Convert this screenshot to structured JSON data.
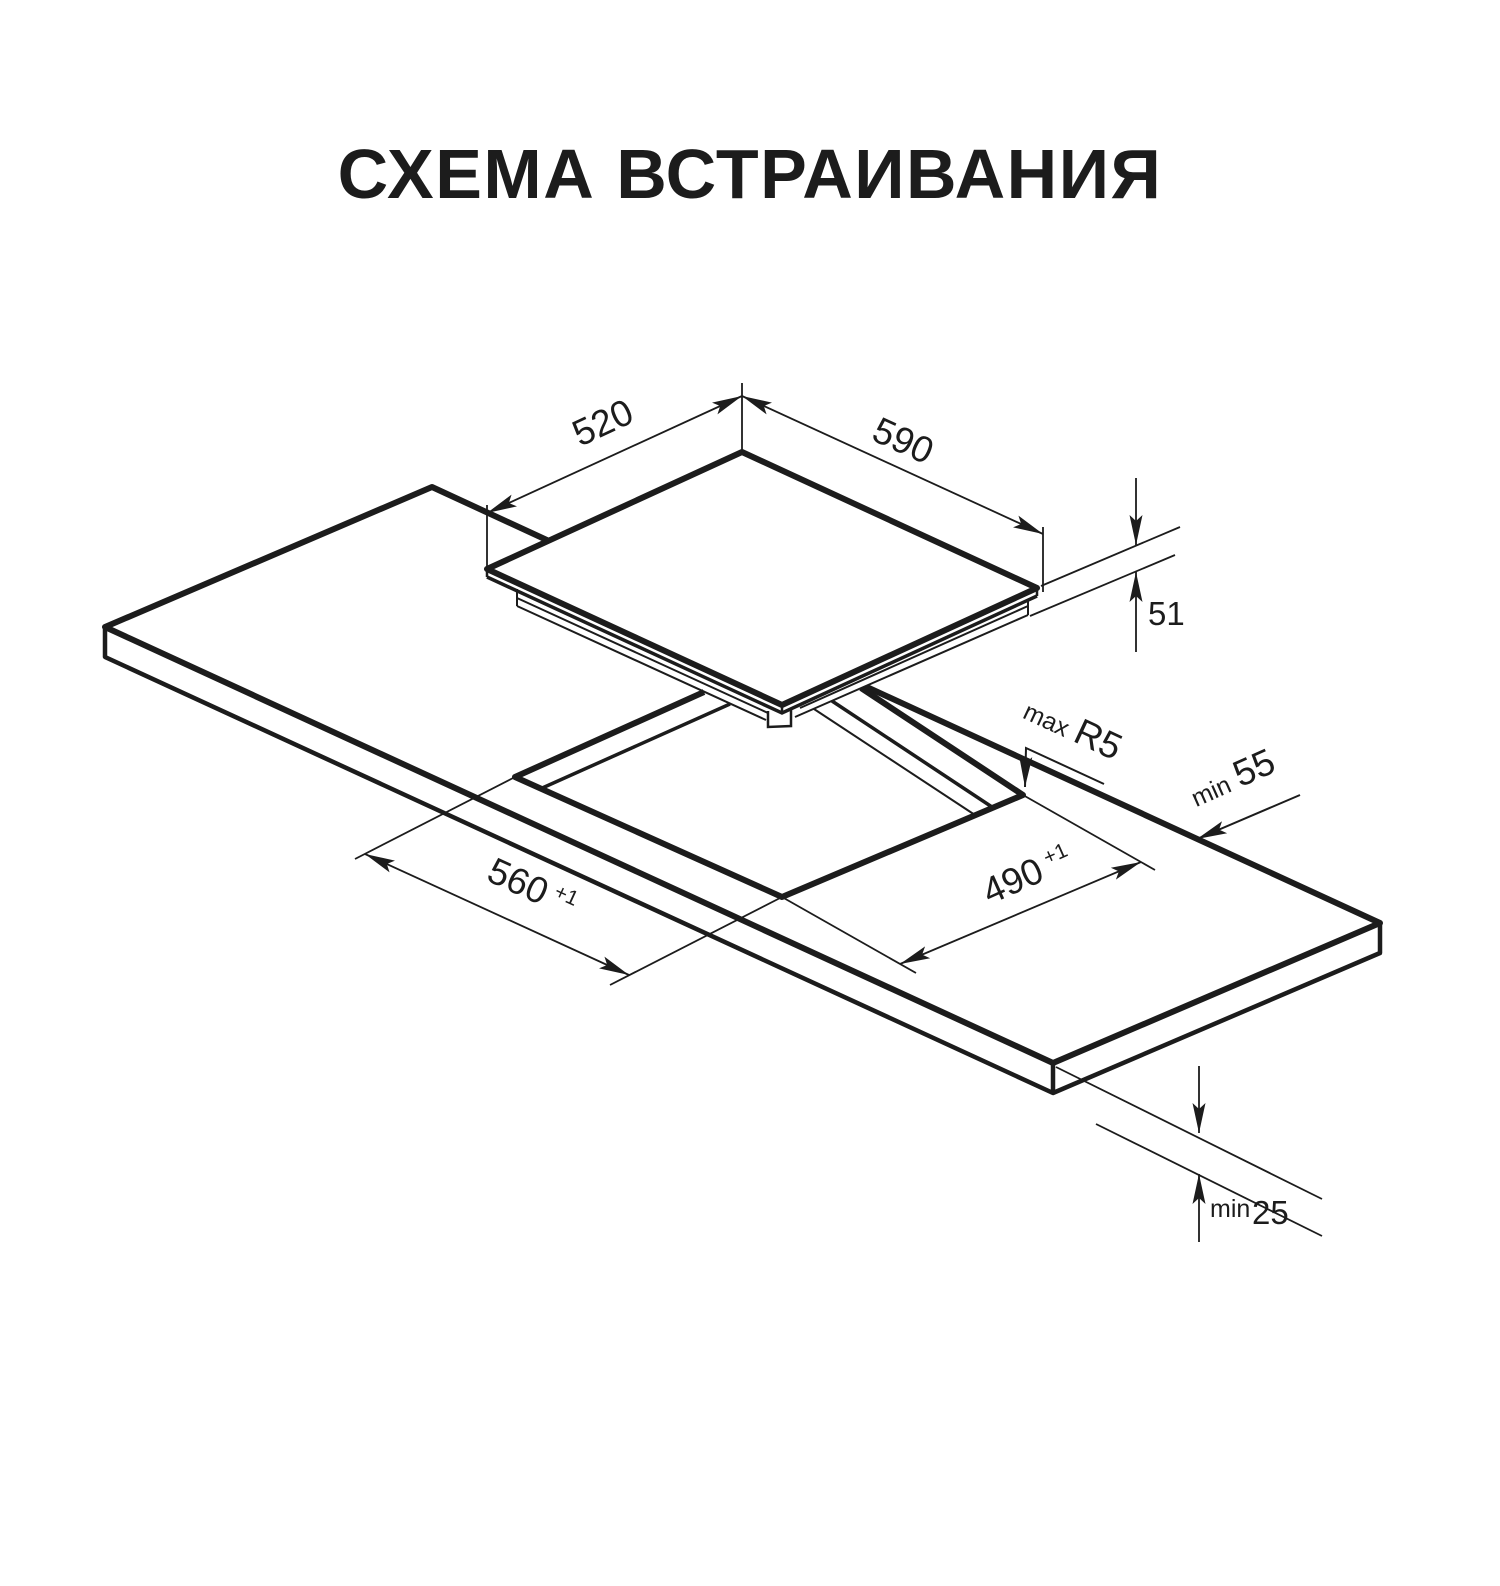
{
  "title": "СХЕМА ВСТРАИВАНИЯ",
  "colors": {
    "line": "#1c1c1c",
    "background": "#ffffff"
  },
  "hob": {
    "width": "590",
    "depth": "520",
    "height": "51"
  },
  "cutout": {
    "width": "560",
    "width_tolerance": "+1",
    "depth": "490",
    "depth_tolerance": "+1",
    "radius_prefix": "max",
    "radius": "R5"
  },
  "clearances": {
    "rear_prefix": "min",
    "rear": "55",
    "bottom_prefix": "min",
    "bottom": "25"
  }
}
